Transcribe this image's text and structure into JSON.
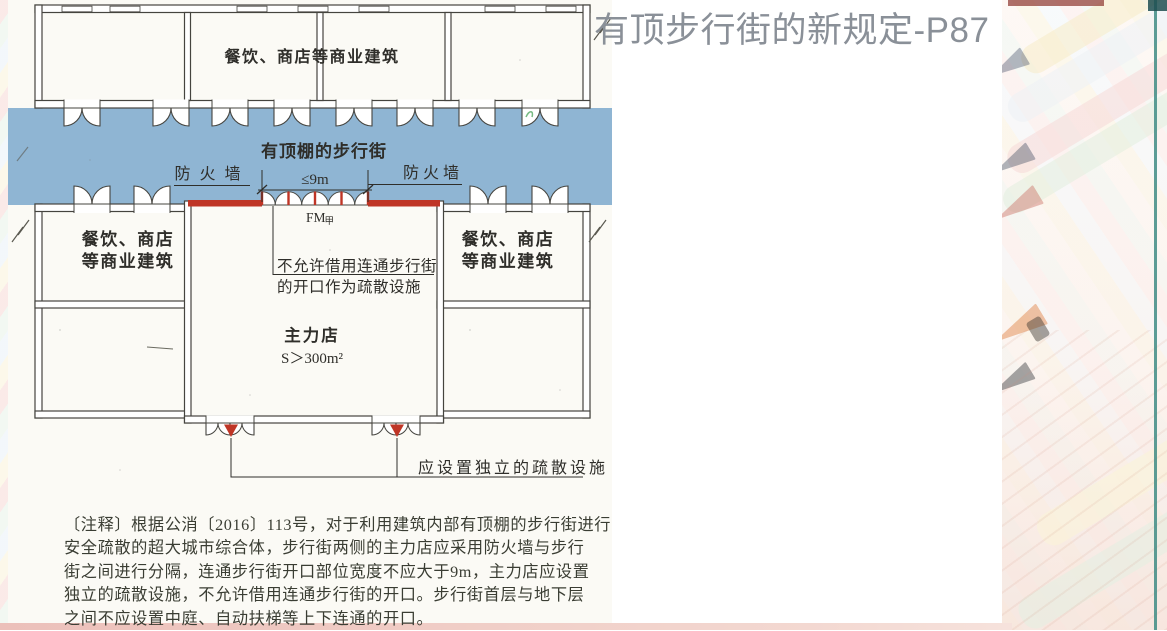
{
  "slide": {
    "title": "有顶步行街的新规定-P87"
  },
  "diagram": {
    "labels": {
      "top_building": "餐饮、商店等商业建筑",
      "street": "有顶棚的步行街",
      "firewall_left": "防火墙",
      "firewall_right": "防火墙",
      "dimension": "≤9m",
      "fire_door": "FM",
      "fire_door_class": "甲",
      "left_building_line1": "餐饮、商店",
      "left_building_line2": "等商业建筑",
      "right_building_line1": "餐饮、商店",
      "right_building_line2": "等商业建筑",
      "no_borrow_line1": "不允许借用连通步行街",
      "no_borrow_line2": "的开口作为疏散设施",
      "main_store": "主力店",
      "main_store_area": "S＞300m²",
      "independent_exit": "应设置独立的疏散设施"
    },
    "colors": {
      "street_fill": "#8fb5d3",
      "firewall_red": "#bf3526",
      "wall": "#45443f"
    }
  },
  "note": {
    "lines": [
      "〔注释〕根据公消〔2016〕113号，对于利用建筑内部有顶棚的步行街进行",
      "安全疏散的超大城市综合体，步行街两侧的主力店应采用防火墙与步行",
      "街之间进行分隔，连通步行街开口部位宽度不应大于9m，主力店应设置",
      "独立的疏散设施，不允许借用连通步行街的开口。步行街首层与地下层",
      "之间不应设置中庭、自动扶梯等上下连通的开口。"
    ]
  }
}
